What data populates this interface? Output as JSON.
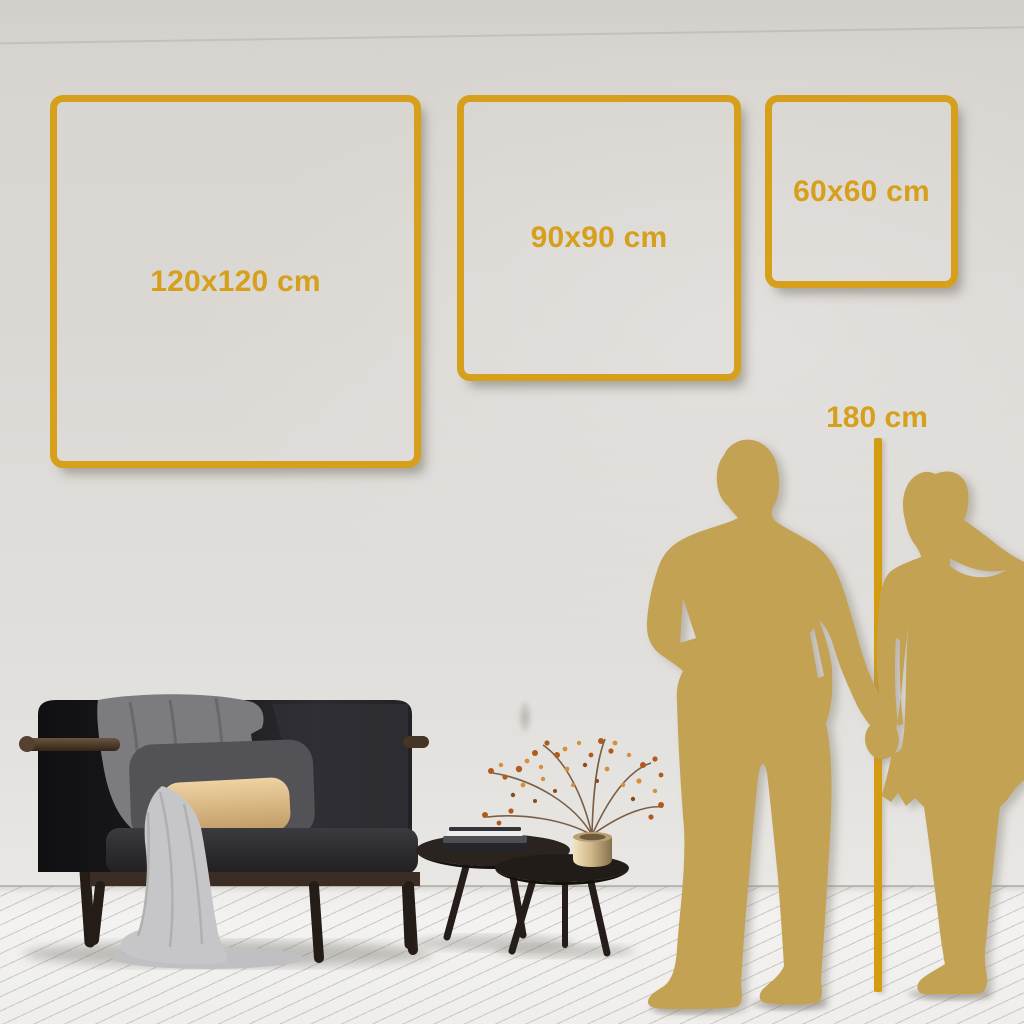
{
  "size_frames": [
    {
      "label": "120x120 cm"
    },
    {
      "label": "90x90 cm"
    },
    {
      "label": "60x60 cm"
    }
  ],
  "height_reference": {
    "label": "180 cm"
  },
  "colors": {
    "accent_gold": "#d6a01c",
    "ruler_gold": "#d49c10",
    "silhouette_gold": "#c3a254",
    "wall_gray": "#dbd8d4",
    "floor_white": "#f1f0ee",
    "sofa_charcoal": "#1d1d20",
    "pillow_beige": "#dfc092",
    "blanket_gray": "#7c7c80",
    "throw_light_gray": "#c6c6c8",
    "wood_brown": "#3a2c21",
    "vase_brass": "#d2b88a",
    "plant_rust": "#b05a1e"
  },
  "scene": {
    "silhouettes": "couple-holding-hands",
    "furniture": [
      "dark-velvet-sofa",
      "nesting-coffee-tables",
      "brass-vase-with-dried-plant"
    ],
    "floor": "white-wood-planks",
    "wall": "light-gray"
  }
}
